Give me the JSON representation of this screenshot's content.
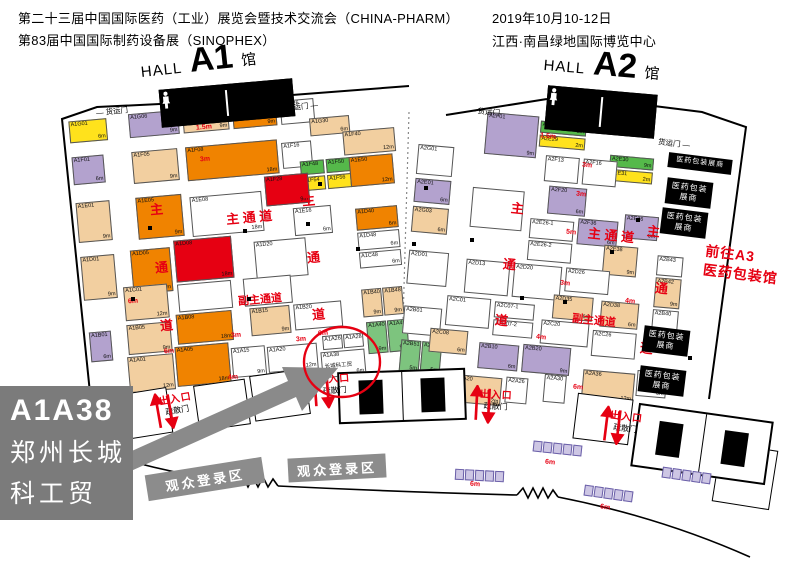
{
  "header": {
    "title1": "第二十三届中国国际医药（工业）展览会暨技术交流会（CHINA-PHARM）",
    "title2": "第83届中国国际制药设备展（SINOPHEX）",
    "date": "2019年10月10-12日",
    "venue": "江西·南昌绿地国际博览中心"
  },
  "palette": {
    "o": "#F08300",
    "r": "#E60012",
    "p": "#B3A2CE",
    "t": "#F2CFA0",
    "g": "#7DC47E",
    "gs": "#55B94A",
    "y": "#FFE21C",
    "w": "#FFFFFF",
    "accent_red": "#E60012",
    "gray": "#8C8C8C",
    "callout_gray": "#7B7B7B"
  },
  "halls": [
    {
      "hall": "HALL",
      "num": "A1",
      "suffix": "馆",
      "x": 62,
      "y": 118,
      "w": 332,
      "h": 300,
      "rot": -5,
      "lx": 140,
      "ly": 46,
      "lr": -6,
      "booths": [
        [
          6,
          4,
          38,
          22,
          "y",
          "A1G01",
          "6m"
        ],
        [
          66,
          2,
          50,
          24,
          "p",
          "A1G06",
          "9m"
        ],
        [
          120,
          2,
          46,
          24,
          "t",
          "A1G08",
          "9m"
        ],
        [
          170,
          2,
          44,
          24,
          "o",
          "A1G20",
          "9m"
        ],
        [
          218,
          2,
          34,
          24,
          "w",
          "A1G26",
          ""
        ],
        [
          246,
          22,
          40,
          18,
          "t",
          "A1G30",
          "6m"
        ],
        [
          6,
          40,
          32,
          28,
          "p",
          "A1F01",
          "6m"
        ],
        [
          66,
          40,
          46,
          32,
          "t",
          "A1F05",
          "9m"
        ],
        [
          120,
          40,
          92,
          34,
          "o",
          "A1F08",
          "18m"
        ],
        [
          216,
          44,
          30,
          26,
          "w",
          "A1F16",
          ""
        ],
        [
          278,
          38,
          52,
          24,
          "t",
          "A1F40",
          "12m"
        ],
        [
          233,
          64,
          24,
          14,
          "gs",
          "A1F48",
          ""
        ],
        [
          259,
          64,
          24,
          14,
          "gs",
          "A1F50",
          ""
        ],
        [
          233,
          80,
          24,
          14,
          "y",
          "A1F54",
          ""
        ],
        [
          259,
          80,
          24,
          14,
          "y",
          "A1F56",
          ""
        ],
        [
          6,
          86,
          34,
          40,
          "t",
          "A1E01",
          "9m"
        ],
        [
          66,
          86,
          46,
          42,
          "o",
          "A1E05",
          "9m"
        ],
        [
          120,
          90,
          72,
          40,
          "w",
          "A1E08",
          "18m"
        ],
        [
          196,
          76,
          44,
          30,
          "r",
          "A1F28",
          "9m"
        ],
        [
          222,
          110,
          38,
          28,
          "w",
          "A1E16",
          "6m"
        ],
        [
          282,
          64,
          44,
          30,
          "o",
          "A1E50",
          "12m"
        ],
        [
          6,
          140,
          34,
          44,
          "t",
          "A1D01",
          "9m"
        ],
        [
          56,
          138,
          40,
          44,
          "o",
          "A1D05",
          "12m"
        ],
        [
          100,
          132,
          58,
          42,
          "r",
          "A1D08",
          "18m"
        ],
        [
          180,
          140,
          52,
          38,
          "w",
          "A1D20",
          ""
        ],
        [
          284,
          116,
          42,
          22,
          "o",
          "A1D40",
          "6m"
        ],
        [
          284,
          140,
          42,
          18,
          "w",
          "A1D48",
          "6m"
        ],
        [
          46,
          174,
          44,
          34,
          "t",
          "A1C01",
          "12m"
        ],
        [
          100,
          176,
          54,
          28,
          "w",
          "",
          ""
        ],
        [
          166,
          176,
          48,
          28,
          "w",
          "",
          ""
        ],
        [
          284,
          160,
          42,
          16,
          "w",
          "A1C48",
          "6m"
        ],
        [
          8,
          216,
          22,
          30,
          "p",
          "A1B01",
          "6m"
        ],
        [
          46,
          212,
          44,
          30,
          "t",
          "A1B05",
          "9m"
        ],
        [
          96,
          206,
          56,
          30,
          "o",
          "A1B08",
          "18m"
        ],
        [
          170,
          206,
          40,
          28,
          "t",
          "A1B15",
          "9m"
        ],
        [
          214,
          206,
          48,
          26,
          "w",
          "A1B20",
          ""
        ],
        [
          283,
          197,
          20,
          28,
          "t",
          "A1B40",
          "9m"
        ],
        [
          304,
          197,
          20,
          28,
          "t",
          "A1B48",
          "9m"
        ],
        [
          44,
          244,
          46,
          36,
          "t",
          "A1A01",
          "12m"
        ],
        [
          92,
          238,
          54,
          40,
          "o",
          "A1A05",
          "18m"
        ],
        [
          148,
          244,
          34,
          30,
          "w",
          "A1A15",
          "9m"
        ],
        [
          184,
          246,
          50,
          26,
          "w",
          "A1A20",
          "12m"
        ],
        [
          240,
          240,
          20,
          14,
          "w",
          "A1A26",
          ""
        ],
        [
          261,
          240,
          20,
          14,
          "w",
          "A1A28",
          ""
        ],
        [
          237,
          256,
          44,
          26,
          "w",
          "A1A38",
          "6m",
          "长城科工贸"
        ],
        [
          285,
          230,
          20,
          32,
          "g",
          "A1A40",
          "9m"
        ],
        [
          306,
          230,
          20,
          32,
          "g",
          "A1A48",
          "9m"
        ]
      ]
    },
    {
      "hall": "HALL",
      "num": "A2",
      "suffix": "馆",
      "x": 420,
      "y": 104,
      "w": 320,
      "h": 300,
      "rot": 5,
      "lx": 544,
      "ly": 50,
      "lr": 5,
      "booths": [
        [
          2,
          40,
          36,
          30,
          "w",
          "A2G01",
          ""
        ],
        [
          2,
          74,
          36,
          24,
          "p",
          "A2E01",
          "6m"
        ],
        [
          2,
          102,
          36,
          26,
          "t",
          "A2G03",
          "6m"
        ],
        [
          2,
          146,
          40,
          34,
          "w",
          "A2D01",
          ""
        ],
        [
          2,
          202,
          38,
          28,
          "w",
          "A2B01",
          ""
        ],
        [
          2,
          236,
          20,
          32,
          "g",
          "A2B51",
          "5m"
        ],
        [
          23,
          236,
          20,
          32,
          "g",
          "A2B58",
          "5m"
        ],
        [
          68,
          2,
          52,
          42,
          "p",
          "A2F01",
          "9m"
        ],
        [
          122,
          6,
          46,
          12,
          "gs",
          "A2E28",
          "2m"
        ],
        [
          122,
          20,
          46,
          12,
          "y",
          "A2E29",
          "2m"
        ],
        [
          194,
          34,
          44,
          12,
          "gs",
          "A2E30",
          "9m"
        ],
        [
          194,
          48,
          44,
          12,
          "y",
          "A2E31",
          "2m"
        ],
        [
          130,
          40,
          34,
          26,
          "w",
          "A2F13",
          ""
        ],
        [
          168,
          40,
          34,
          26,
          "w",
          "A2F16",
          ""
        ],
        [
          136,
          70,
          38,
          28,
          "p",
          "A2F20",
          "6m"
        ],
        [
          168,
          100,
          40,
          26,
          "p",
          "A2F36",
          "6m"
        ],
        [
          214,
          92,
          34,
          24,
          "p",
          "A2E36",
          "6m"
        ],
        [
          196,
          124,
          34,
          30,
          "t",
          "A2E38",
          "9m"
        ],
        [
          60,
          78,
          52,
          40,
          "w",
          "",
          ""
        ],
        [
          120,
          104,
          44,
          20,
          "w",
          "A2E26-1",
          ""
        ],
        [
          120,
          126,
          44,
          20,
          "w",
          "A2E26-2",
          ""
        ],
        [
          60,
          150,
          44,
          34,
          "w",
          "A2D13",
          ""
        ],
        [
          108,
          150,
          48,
          34,
          "w",
          "A2D20",
          ""
        ],
        [
          160,
          150,
          44,
          24,
          "w",
          "A2D26",
          ""
        ],
        [
          150,
          178,
          40,
          24,
          "t",
          "A2D35",
          "6m"
        ],
        [
          198,
          180,
          38,
          26,
          "t",
          "A2D38",
          "6m"
        ],
        [
          250,
          130,
          26,
          20,
          "w",
          "A2B43",
          ""
        ],
        [
          250,
          152,
          26,
          30,
          "t",
          "A2B42",
          "9m"
        ],
        [
          250,
          184,
          26,
          24,
          "w",
          "A2B40",
          ""
        ],
        [
          44,
          188,
          44,
          30,
          "w",
          "A2C01",
          ""
        ],
        [
          30,
          222,
          38,
          24,
          "t",
          "A2C08",
          "6m"
        ],
        [
          92,
          190,
          40,
          16,
          "w",
          "A2C07-1",
          ""
        ],
        [
          92,
          208,
          40,
          16,
          "w",
          "A2C07-2",
          ""
        ],
        [
          140,
          204,
          48,
          24,
          "w",
          "A2C20",
          ""
        ],
        [
          192,
          210,
          44,
          26,
          "w",
          "A2C26",
          ""
        ],
        [
          80,
          232,
          40,
          26,
          "p",
          "A2B10",
          "6m"
        ],
        [
          124,
          230,
          48,
          28,
          "p",
          "A2B20",
          "9m"
        ],
        [
          58,
          266,
          48,
          28,
          "t",
          "A2A20",
          "12m"
        ],
        [
          110,
          264,
          22,
          26,
          "w",
          "A2A26",
          ""
        ],
        [
          148,
          258,
          22,
          28,
          "w",
          "A2A30",
          ""
        ],
        [
          186,
          250,
          52,
          30,
          "t",
          "A2A36",
          "12m"
        ],
        [
          240,
          246,
          30,
          26,
          "w",
          "A2A40",
          "6m"
        ]
      ]
    }
  ],
  "aisle_labels": [
    {
      "t": "主",
      "x": 150,
      "y": 199,
      "r": -5
    },
    {
      "t": "通",
      "x": 155,
      "y": 257,
      "r": -5
    },
    {
      "t": "道",
      "x": 160,
      "y": 315,
      "r": -5
    },
    {
      "t": "主 通 道",
      "x": 226,
      "y": 207,
      "r": -5
    },
    {
      "t": "主",
      "x": 302,
      "y": 190,
      "r": -5
    },
    {
      "t": "通",
      "x": 307,
      "y": 247,
      "r": -5
    },
    {
      "t": "道",
      "x": 312,
      "y": 304,
      "r": -5
    },
    {
      "t": "副主通道",
      "x": 238,
      "y": 291,
      "r": -5,
      "s": 11
    },
    {
      "t": "主 通 道",
      "x": 588,
      "y": 225,
      "r": 6
    },
    {
      "t": "主",
      "x": 511,
      "y": 198,
      "r": 6
    },
    {
      "t": "通",
      "x": 503,
      "y": 254,
      "r": 6
    },
    {
      "t": "道",
      "x": 495,
      "y": 310,
      "r": 6
    },
    {
      "t": "主",
      "x": 647,
      "y": 221,
      "r": 6
    },
    {
      "t": "通",
      "x": 655,
      "y": 278,
      "r": 6
    },
    {
      "t": "道",
      "x": 640,
      "y": 338,
      "r": 6
    },
    {
      "t": "副主通道",
      "x": 572,
      "y": 312,
      "r": 6,
      "s": 11
    }
  ],
  "measures": [
    [
      "1.5m",
      196,
      124,
      -5
    ],
    [
      "3m",
      200,
      156,
      -5
    ],
    [
      "5m",
      208,
      238,
      -5
    ],
    [
      "6m",
      128,
      298,
      -5
    ],
    [
      "6m",
      164,
      348,
      -5
    ],
    [
      "4m",
      228,
      374,
      -5
    ],
    [
      "3m",
      231,
      332,
      -5
    ],
    [
      "3m",
      296,
      336,
      -5
    ],
    [
      "6m",
      318,
      330,
      -5
    ],
    [
      "1.5m",
      540,
      133,
      6
    ],
    [
      "3m",
      582,
      162,
      6
    ],
    [
      "3m",
      576,
      191,
      6
    ],
    [
      "5m",
      566,
      229,
      6
    ],
    [
      "3m",
      560,
      280,
      6
    ],
    [
      "4m",
      625,
      298,
      6
    ],
    [
      "4m",
      536,
      334,
      6
    ],
    [
      "6m",
      573,
      384,
      6
    ],
    [
      "6m",
      545,
      459,
      6
    ],
    [
      "6m",
      470,
      481,
      4
    ],
    [
      "6m",
      600,
      504,
      8
    ]
  ],
  "doors": [
    {
      "t": "— 货运门",
      "x": 96,
      "y": 106,
      "r": -6
    },
    {
      "t": "货运门 —",
      "x": 286,
      "y": 101,
      "r": -6
    },
    {
      "t": "— 货运门",
      "x": 468,
      "y": 106,
      "r": 5
    },
    {
      "t": "货运门 —",
      "x": 658,
      "y": 138,
      "r": 7
    }
  ],
  "exits": {
    "label": "出入口",
    "door": "疏散门",
    "positions": [
      [
        148,
        390,
        -10
      ],
      [
        306,
        370,
        -4
      ],
      [
        468,
        386,
        3
      ],
      [
        598,
        408,
        7
      ]
    ]
  },
  "registration_bars": {
    "label": "观众登录区",
    "positions": [
      [
        146,
        466,
        118,
        26,
        -9
      ],
      [
        288,
        456,
        98,
        24,
        -3
      ]
    ]
  },
  "packaging_boxes": {
    "single": "医药包装展商",
    "line1": "医药包装",
    "line2": "展商",
    "single_pos": [
      668,
      156,
      64,
      15,
      7
    ],
    "positions": [
      [
        666,
        180,
        46,
        26,
        7
      ],
      [
        661,
        210,
        46,
        26,
        7
      ],
      [
        643,
        328,
        46,
        26,
        7
      ],
      [
        639,
        368,
        46,
        26,
        7
      ]
    ]
  },
  "goto_a3": {
    "line1": "前往A3",
    "line2": "医药包装馆",
    "x": 704,
    "y": 246,
    "r": 7
  },
  "callout": {
    "code": "A1A38",
    "name1": "郑州长城",
    "name2": "科工贸"
  },
  "highlight": {
    "booth": "A1A38",
    "name": "长城科工贸",
    "dim": "6m"
  },
  "restrooms": {
    "top": [
      [
        160,
        84,
        132,
        36,
        -5
      ],
      [
        546,
        90,
        108,
        42,
        5
      ]
    ],
    "bottom": [
      [
        338,
        370,
        128,
        52,
        -2
      ],
      [
        634,
        412,
        136,
        64,
        8
      ]
    ]
  },
  "structures": [
    [
      34,
      402,
      44,
      54,
      -14
    ],
    [
      84,
      390,
      46,
      50,
      -11
    ],
    [
      128,
      390,
      42,
      46,
      -9
    ],
    [
      196,
      382,
      52,
      46,
      -8
    ],
    [
      252,
      372,
      56,
      46,
      -8
    ],
    [
      575,
      396,
      56,
      46,
      7
    ],
    [
      716,
      446,
      58,
      60,
      9
    ]
  ],
  "strips": [
    [
      533,
      443,
      6
    ],
    [
      455,
      470,
      3
    ],
    [
      584,
      488,
      8
    ],
    [
      662,
      470,
      8
    ]
  ],
  "pillars": [
    [
      148,
      226
    ],
    [
      243,
      229
    ],
    [
      306,
      222
    ],
    [
      356,
      247
    ],
    [
      131,
      297
    ],
    [
      247,
      297
    ],
    [
      424,
      186
    ],
    [
      470,
      238
    ],
    [
      520,
      296
    ],
    [
      563,
      300
    ],
    [
      610,
      250
    ],
    [
      636,
      218
    ],
    [
      688,
      356
    ],
    [
      318,
      182
    ],
    [
      412,
      242
    ]
  ]
}
